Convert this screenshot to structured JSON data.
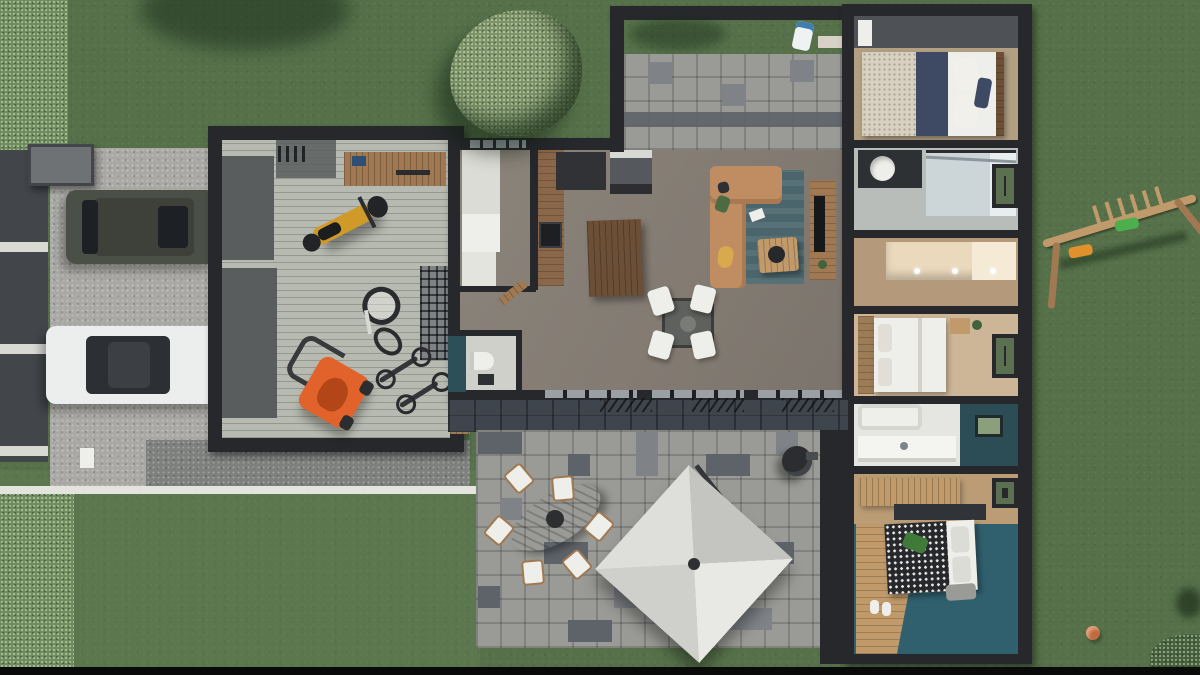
{
  "scene": {
    "kind": "3d-aerial-floor-plan-render",
    "areas": [
      {
        "name": "front-yard",
        "objects": [
          "hedge",
          "fence",
          "shed",
          "gravel-driveway",
          "suv-car",
          "white-sedan",
          "concrete-apron"
        ]
      },
      {
        "name": "garage",
        "objects": [
          "floor-mats",
          "wall-ladder",
          "workbench",
          "motorcycle",
          "fallen-bicycle",
          "storage-rack",
          "standing-bicycles",
          "lawnmower"
        ]
      },
      {
        "name": "utility-room",
        "objects": [
          "washer",
          "dryer",
          "white-counter",
          "open-door"
        ]
      },
      {
        "name": "kitchen",
        "objects": [
          "wood-counter",
          "cooktop",
          "tall-appliance",
          "butcher-block-island"
        ]
      },
      {
        "name": "dining",
        "objects": [
          "glass-table",
          "white-chairs"
        ]
      },
      {
        "name": "living-room",
        "objects": [
          "l-shaped-sofa",
          "area-rug",
          "coffee-table",
          "tv-console",
          "tv"
        ]
      },
      {
        "name": "wc",
        "objects": [
          "toilet",
          "accent-wall"
        ]
      },
      {
        "name": "north-terrace",
        "objects": [
          "pergola-frame",
          "grass-strip",
          "robot-mower",
          "pavers",
          "doormat"
        ]
      },
      {
        "name": "bedroom-1",
        "objects": [
          "double-bed-navy",
          "headboard",
          "pillows"
        ]
      },
      {
        "name": "bathroom-1",
        "objects": [
          "dark-vanity",
          "round-basin",
          "walk-in-shower",
          "window"
        ]
      },
      {
        "name": "dressing",
        "objects": [
          "cream-wardrobe"
        ]
      },
      {
        "name": "bedroom-2",
        "objects": [
          "white-bed",
          "plank-headboard",
          "nightstand",
          "window"
        ]
      },
      {
        "name": "bathroom-2",
        "objects": [
          "bathtub",
          "white-vanity",
          "teal-accent-wall"
        ]
      },
      {
        "name": "office-nook",
        "objects": [
          "wood-desk",
          "dark-desk",
          "window"
        ]
      },
      {
        "name": "master-bedroom",
        "objects": [
          "houndstooth-bed",
          "pillows",
          "bench",
          "teal-floor",
          "wood-floor"
        ]
      },
      {
        "name": "patio",
        "objects": [
          "stone-pavers",
          "oval-garden-table",
          "six-garden-chairs",
          "cantilever-parasol",
          "bbq-grill"
        ]
      },
      {
        "name": "side-yard",
        "objects": [
          "wooden-swing-set",
          "orange-swing",
          "green-swing",
          "orange-ball",
          "corner-bush"
        ]
      },
      {
        "name": "back-yard",
        "objects": [
          "round-tree",
          "tree-shadow"
        ]
      }
    ]
  },
  "colors": {
    "grass": "#56714a",
    "grassLight": "#607c53",
    "hedge": "#6f8c5d",
    "treeFoliage": "#7d9468",
    "treeDark": "#47603c",
    "gravel": "#a9a8a4",
    "apron": "#7e807d",
    "curb": "#e4e4df",
    "fencePanel": "#42464a",
    "fencePost": "#d9d9d4",
    "shed": "#6e7275",
    "suvBody": "#4b5046",
    "suvGlass": "#1d2024",
    "taillight": "#932222",
    "sedanBody": "#eceded",
    "sedanGlass": "#2c3034",
    "wall": "#27282c",
    "wallLight": "#4e5156",
    "garageFloor": "#b7bab0",
    "mat": "#595d5e",
    "wood": "#8a6748",
    "woodLight": "#c09a6a",
    "woodMid": "#a07952",
    "woodDark": "#6b4f37",
    "white": "#eeeeea",
    "cream": "#ead9bc",
    "floorTaupe": "#837b72",
    "floorGray": "#c2c4bf",
    "rug": "#4a666c",
    "sofa": "#bf8d61",
    "tvDark": "#17181a",
    "teal": "#2c4f58",
    "tealFloor": "#30606e",
    "navy": "#3e4a63",
    "beddingBeige": "#d8d1c1",
    "basalt": "#3f454d",
    "paver": "#9a9b97",
    "paverDark": "#5d6369",
    "paverMid": "#7f8388",
    "umbrella": "#dcdcd8",
    "umbrellaShade": "#c2c2be",
    "orange": "#e2622c",
    "moto": "#d09a28",
    "green": "#4cae4c",
    "swingOrange": "#e0902c",
    "ball": "#c06a3e",
    "black": "#0a0a0a",
    "robot": "#eef2f3",
    "robotBlue": "#3f7fae",
    "glassGreen": "#5a7050",
    "shower": "#ccd6d8",
    "bath2": "#2c4d55",
    "blanket": "#26282c",
    "benchGray": "#9a9a96",
    "floorBeige": "#cdb697",
    "floorWood": "#b3a083"
  }
}
